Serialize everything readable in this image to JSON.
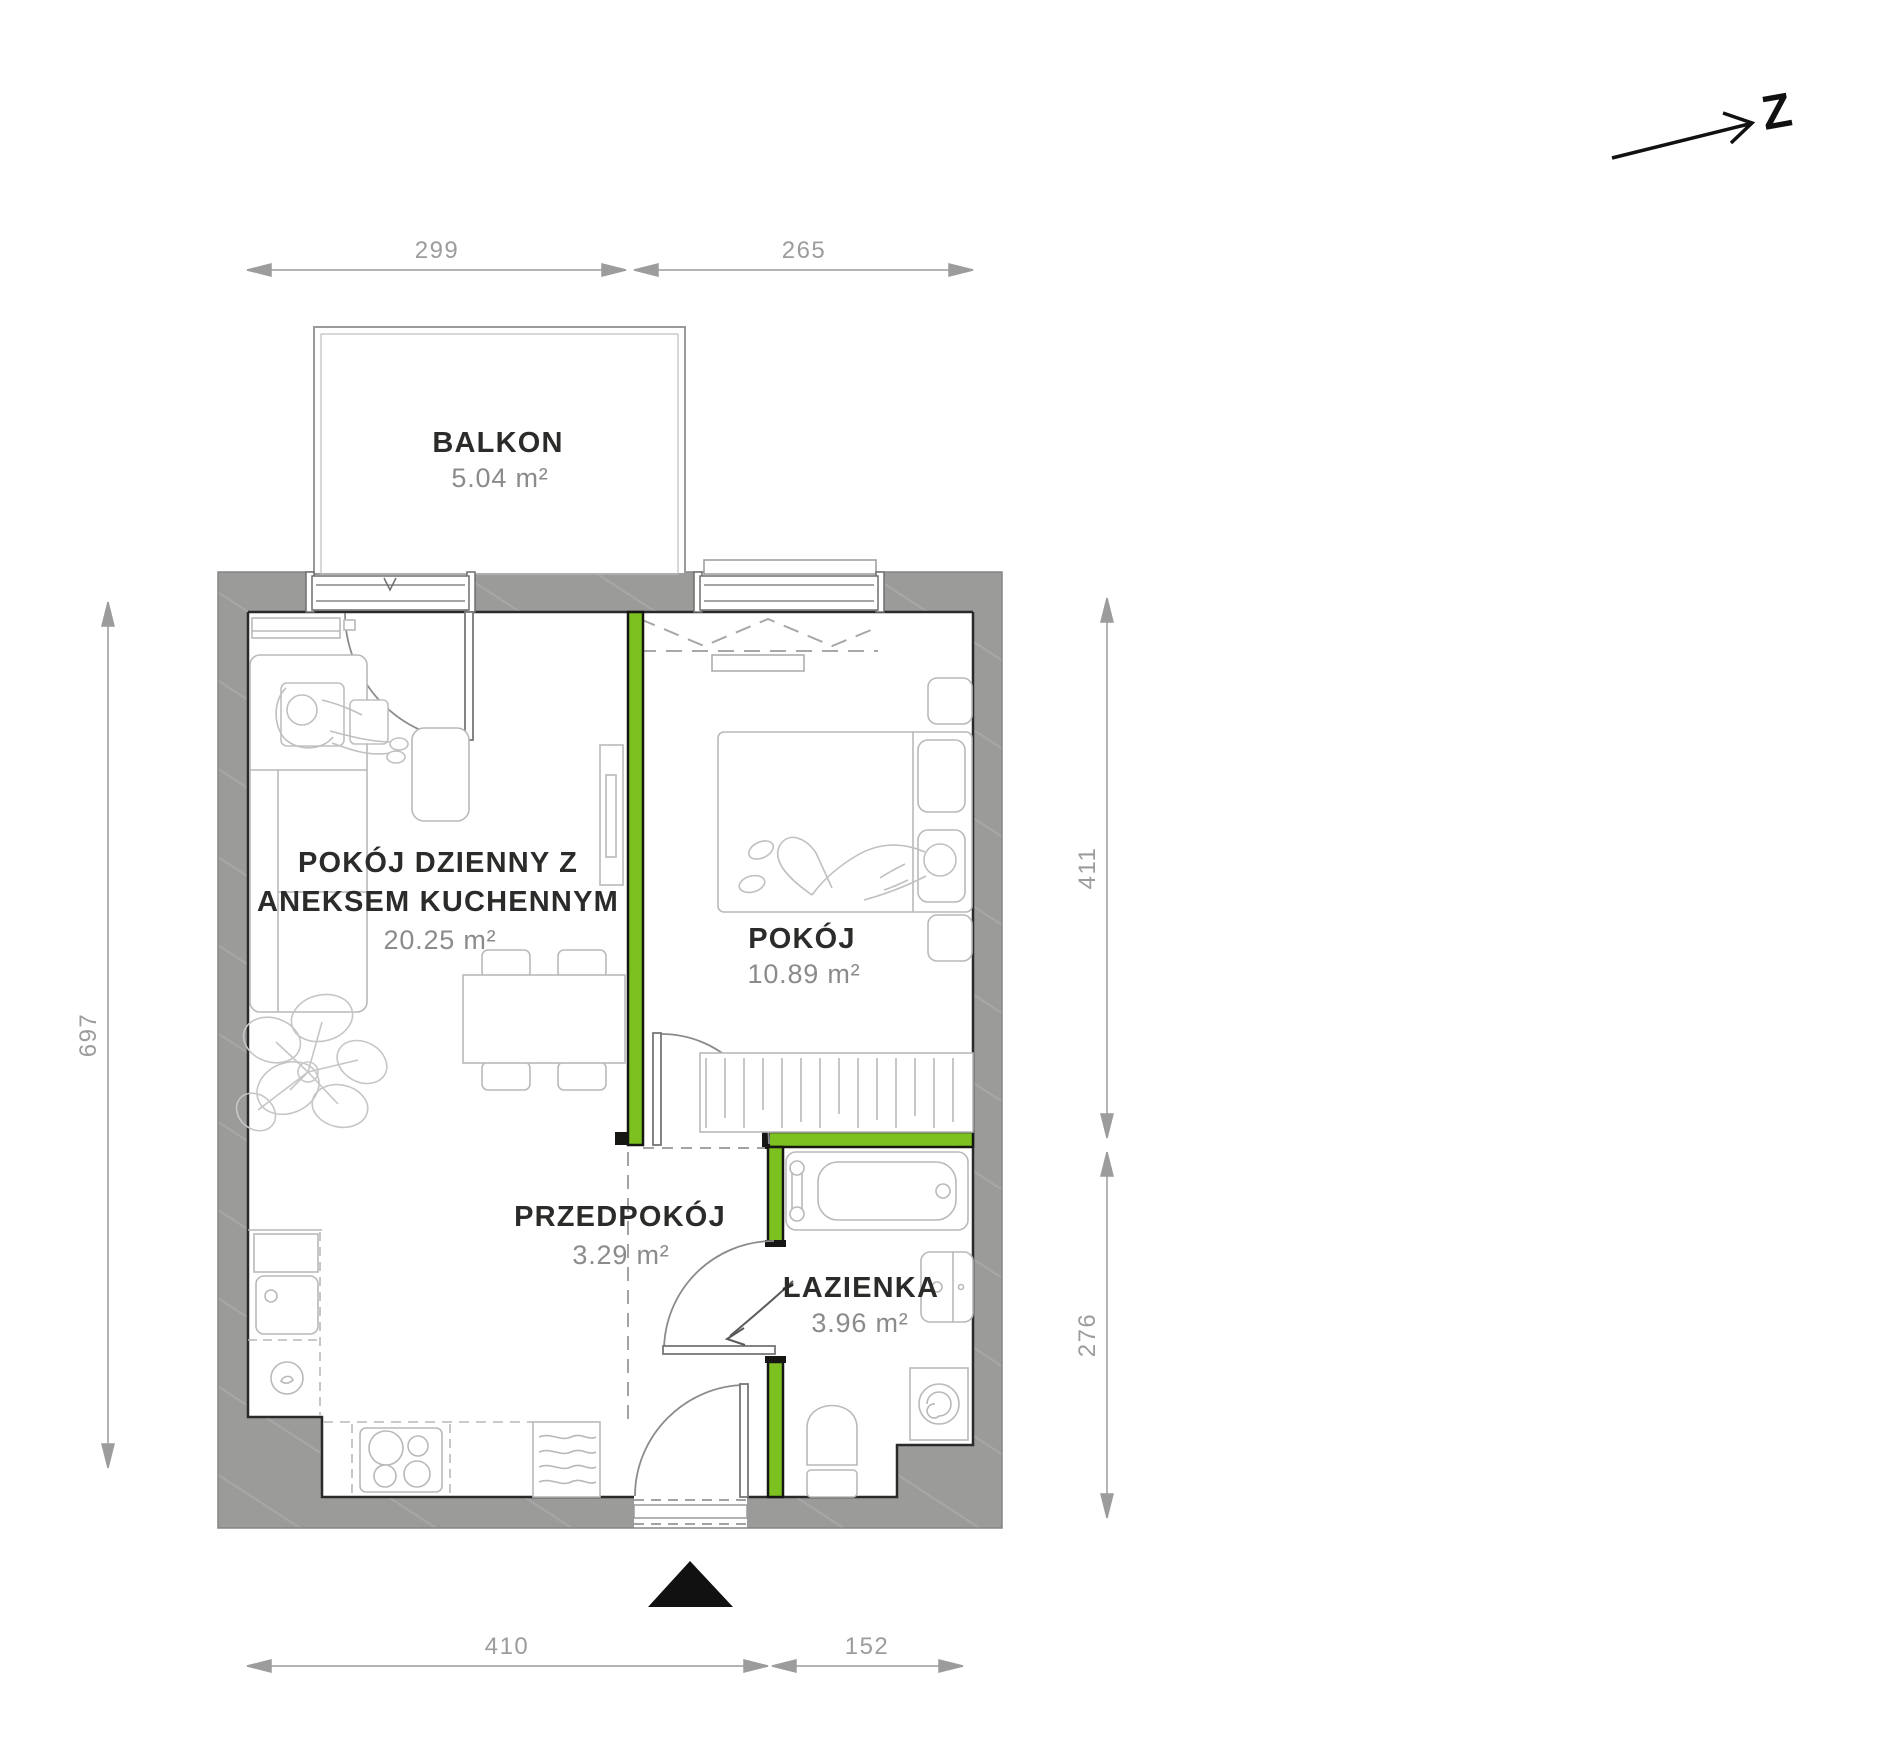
{
  "plan": {
    "title": "Apartment floor plan",
    "compass": {
      "label": "Z"
    },
    "rooms": {
      "balkon": {
        "name": "BALKON",
        "area": "5.04 m²"
      },
      "living": {
        "name_line1": "POKÓJ DZIENNY Z",
        "name_line2": "ANEKSEM KUCHENNYM",
        "area": "20.25 m²"
      },
      "bedroom": {
        "name": "POKÓJ",
        "area": "10.89 m²"
      },
      "hall": {
        "name": "PRZEDPOKÓJ",
        "area": "3.29 m²"
      },
      "bath": {
        "name": "ŁAZIENKA",
        "area": "3.96 m²"
      }
    },
    "dimensions": {
      "top_left": "299",
      "top_right": "265",
      "left": "697",
      "right_upper": "411",
      "right_lower": "276",
      "bottom_left": "410",
      "bottom_right": "152"
    },
    "colors": {
      "accent_green": "#7cc120",
      "wall_gray": "#9b9b9a",
      "dimension_gray": "#9c9c9c",
      "furniture_gray": "#b9b9b9",
      "label_dark": "#2b2b29",
      "area_gray": "#8b8b8b",
      "entrance_marker": "#111111"
    }
  }
}
